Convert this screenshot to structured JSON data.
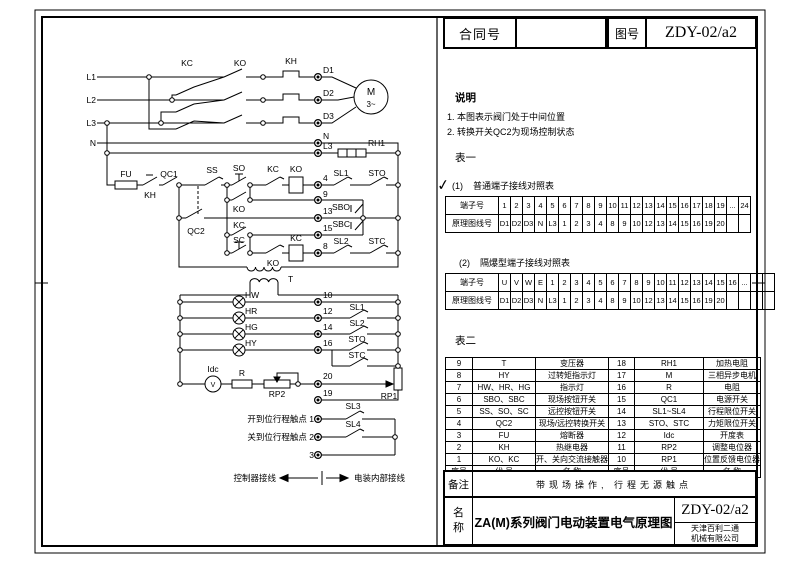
{
  "header": {
    "contract_label": "合同号",
    "contract_value": "",
    "drawing_no_label": "图号",
    "drawing_no_value": "ZDY-02/a2"
  },
  "notes": {
    "title": "说明",
    "items": [
      "1. 本图表示阀门处于中间位置",
      "2. 转换开关QC2为现场控制状态"
    ]
  },
  "table1": {
    "title": "表一",
    "check_icon": "✓",
    "sub1_prefix": "(1)",
    "sub1_title": "普通端子接线对照表",
    "normal": {
      "row1_label": "端子号",
      "row1": [
        "1",
        "2",
        "3",
        "4",
        "5",
        "6",
        "7",
        "8",
        "9",
        "10",
        "11",
        "12",
        "13",
        "14",
        "15",
        "16",
        "17",
        "18",
        "19",
        "...",
        "24"
      ],
      "row2_label": "原理图线号",
      "row2": [
        "D1",
        "D2",
        "D3",
        "N",
        "L3",
        "1",
        "2",
        "3",
        "4",
        "8",
        "9",
        "10",
        "12",
        "13",
        "14",
        "15",
        "16",
        "19",
        "20",
        "",
        ""
      ]
    },
    "sub2_prefix": "(2)",
    "sub2_title": "隔爆型端子接线对照表",
    "explosion": {
      "row1_label": "端子号",
      "row1": [
        "U",
        "V",
        "W",
        "E",
        "1",
        "2",
        "3",
        "4",
        "5",
        "6",
        "7",
        "8",
        "9",
        "10",
        "11",
        "12",
        "13",
        "14",
        "15",
        "16",
        "...",
        "",
        ""
      ],
      "row2_label": "原理图线号",
      "row2": [
        "D1",
        "D2",
        "D3",
        "N",
        "L3",
        "1",
        "2",
        "3",
        "4",
        "8",
        "9",
        "10",
        "12",
        "13",
        "14",
        "15",
        "16",
        "19",
        "20",
        "",
        "",
        ""
      ]
    }
  },
  "table2": {
    "title": "表二",
    "rows": [
      [
        "9",
        "T",
        "变压器",
        "18",
        "RH1",
        "加热电阻"
      ],
      [
        "8",
        "HY",
        "过转矩指示灯",
        "17",
        "M",
        "三相异步电机"
      ],
      [
        "7",
        "HW、HR、HG",
        "指示灯",
        "16",
        "R",
        "电阻"
      ],
      [
        "6",
        "SBO、SBC",
        "现场按钮开关",
        "15",
        "QC1",
        "电源开关"
      ],
      [
        "5",
        "SS、SO、SC",
        "远控按钮开关",
        "14",
        "SL1~SL4",
        "行程限位开关"
      ],
      [
        "4",
        "QC2",
        "现场/远控转换开关",
        "13",
        "STO、STC",
        "力矩限位开关"
      ],
      [
        "3",
        "FU",
        "熔断器",
        "12",
        "Idc",
        "开度表"
      ],
      [
        "2",
        "KH",
        "热继电器",
        "11",
        "RP2",
        "调整电位器"
      ],
      [
        "1",
        "KO、KC",
        "开、关向交流接触器",
        "10",
        "RP1",
        "位置反馈电位器"
      ],
      [
        "序号",
        "代  号",
        "名  称",
        "序号",
        "代  号",
        "名  称"
      ]
    ]
  },
  "title_block": {
    "remark_label": "备注",
    "remark_text": "带现场操作, 行程无源触点",
    "name_label_1": "名",
    "name_label_2": "称",
    "name_text": "ZA(M)系列阀门电动装置电气原理图",
    "drawing_no": "ZDY-02/a2",
    "company_line1": "天津百利二通",
    "company_line2": "机械有限公司"
  },
  "schematic": {
    "labels": [
      {
        "t": "L1",
        "x": 96,
        "y": 80,
        "a": "end"
      },
      {
        "t": "L2",
        "x": 96,
        "y": 103,
        "a": "end"
      },
      {
        "t": "L3",
        "x": 96,
        "y": 126,
        "a": "end"
      },
      {
        "t": "N",
        "x": 96,
        "y": 146,
        "a": "end"
      },
      {
        "t": "KC",
        "x": 187,
        "y": 66,
        "a": "middle"
      },
      {
        "t": "KO",
        "x": 240,
        "y": 66,
        "a": "middle"
      },
      {
        "t": "KH",
        "x": 291,
        "y": 64,
        "a": "middle"
      },
      {
        "t": "D1",
        "x": 323,
        "y": 73
      },
      {
        "t": "D2",
        "x": 323,
        "y": 96
      },
      {
        "t": "D3",
        "x": 323,
        "y": 119
      },
      {
        "t": "N",
        "x": 323,
        "y": 139
      },
      {
        "t": "L3",
        "x": 323,
        "y": 149
      },
      {
        "t": "RH1",
        "x": 368,
        "y": 146
      },
      {
        "t": "M",
        "x": 371,
        "y": 95,
        "a": "middle",
        "s": 10
      },
      {
        "t": "3~",
        "x": 371,
        "y": 107,
        "a": "middle",
        "s": 8
      },
      {
        "t": "FU",
        "x": 126,
        "y": 177,
        "a": "middle"
      },
      {
        "t": "KH",
        "x": 150,
        "y": 198,
        "a": "middle"
      },
      {
        "t": "QC1",
        "x": 169,
        "y": 177,
        "a": "middle"
      },
      {
        "t": "SS",
        "x": 212,
        "y": 173,
        "a": "middle"
      },
      {
        "t": "SO",
        "x": 239,
        "y": 171,
        "a": "middle"
      },
      {
        "t": "KC",
        "x": 273,
        "y": 172,
        "a": "middle"
      },
      {
        "t": "KO",
        "x": 296,
        "y": 172,
        "a": "middle"
      },
      {
        "t": "KO",
        "x": 239,
        "y": 212,
        "a": "middle"
      },
      {
        "t": "QC2",
        "x": 196,
        "y": 234,
        "a": "middle"
      },
      {
        "t": "KC",
        "x": 239,
        "y": 228,
        "a": "middle"
      },
      {
        "t": "SC",
        "x": 239,
        "y": 243,
        "a": "middle"
      },
      {
        "t": "KO",
        "x": 273,
        "y": 266,
        "a": "middle"
      },
      {
        "t": "KC",
        "x": 296,
        "y": 241,
        "a": "middle"
      },
      {
        "t": "4",
        "x": 323,
        "y": 181
      },
      {
        "t": "9",
        "x": 323,
        "y": 197
      },
      {
        "t": "13",
        "x": 323,
        "y": 214
      },
      {
        "t": "15",
        "x": 323,
        "y": 231
      },
      {
        "t": "8",
        "x": 323,
        "y": 249
      },
      {
        "t": "SL1",
        "x": 341,
        "y": 176,
        "a": "middle"
      },
      {
        "t": "STO",
        "x": 377,
        "y": 176,
        "a": "middle"
      },
      {
        "t": "SBO",
        "x": 350,
        "y": 210,
        "a": "end"
      },
      {
        "t": "SBC",
        "x": 350,
        "y": 227,
        "a": "end"
      },
      {
        "t": "SL2",
        "x": 341,
        "y": 244,
        "a": "middle"
      },
      {
        "t": "STC",
        "x": 377,
        "y": 244,
        "a": "middle"
      },
      {
        "t": "T",
        "x": 288,
        "y": 282
      },
      {
        "t": "HW",
        "x": 245,
        "y": 298
      },
      {
        "t": "HR",
        "x": 245,
        "y": 314
      },
      {
        "t": "HG",
        "x": 245,
        "y": 330
      },
      {
        "t": "HY",
        "x": 245,
        "y": 346
      },
      {
        "t": "10",
        "x": 323,
        "y": 298
      },
      {
        "t": "12",
        "x": 323,
        "y": 314
      },
      {
        "t": "14",
        "x": 323,
        "y": 330
      },
      {
        "t": "16",
        "x": 323,
        "y": 346
      },
      {
        "t": "SL1",
        "x": 357,
        "y": 310,
        "a": "middle"
      },
      {
        "t": "SL2",
        "x": 357,
        "y": 326,
        "a": "middle"
      },
      {
        "t": "STO",
        "x": 357,
        "y": 342,
        "a": "middle"
      },
      {
        "t": "STC",
        "x": 357,
        "y": 358,
        "a": "middle"
      },
      {
        "t": "Idc",
        "x": 213,
        "y": 372,
        "a": "middle"
      },
      {
        "t": "V",
        "x": 213,
        "y": 387,
        "a": "middle",
        "s": 7
      },
      {
        "t": "R",
        "x": 242,
        "y": 376,
        "a": "middle"
      },
      {
        "t": "RP2",
        "x": 277,
        "y": 397,
        "a": "middle"
      },
      {
        "t": "20",
        "x": 323,
        "y": 379
      },
      {
        "t": "19",
        "x": 323,
        "y": 396
      },
      {
        "t": "RP1",
        "x": 389,
        "y": 399,
        "a": "middle"
      },
      {
        "t": "开到位行程触点 1",
        "x": 314,
        "y": 422,
        "a": "end"
      },
      {
        "t": "关到位行程触点 2",
        "x": 314,
        "y": 440,
        "a": "end"
      },
      {
        "t": "3",
        "x": 314,
        "y": 458,
        "a": "end"
      },
      {
        "t": "SL3",
        "x": 353,
        "y": 409,
        "a": "middle"
      },
      {
        "t": "SL4",
        "x": 353,
        "y": 427,
        "a": "middle"
      },
      {
        "t": "控制器接线",
        "x": 276,
        "y": 481,
        "a": "end"
      },
      {
        "t": "电装内部接线",
        "x": 354,
        "y": 481
      }
    ]
  }
}
